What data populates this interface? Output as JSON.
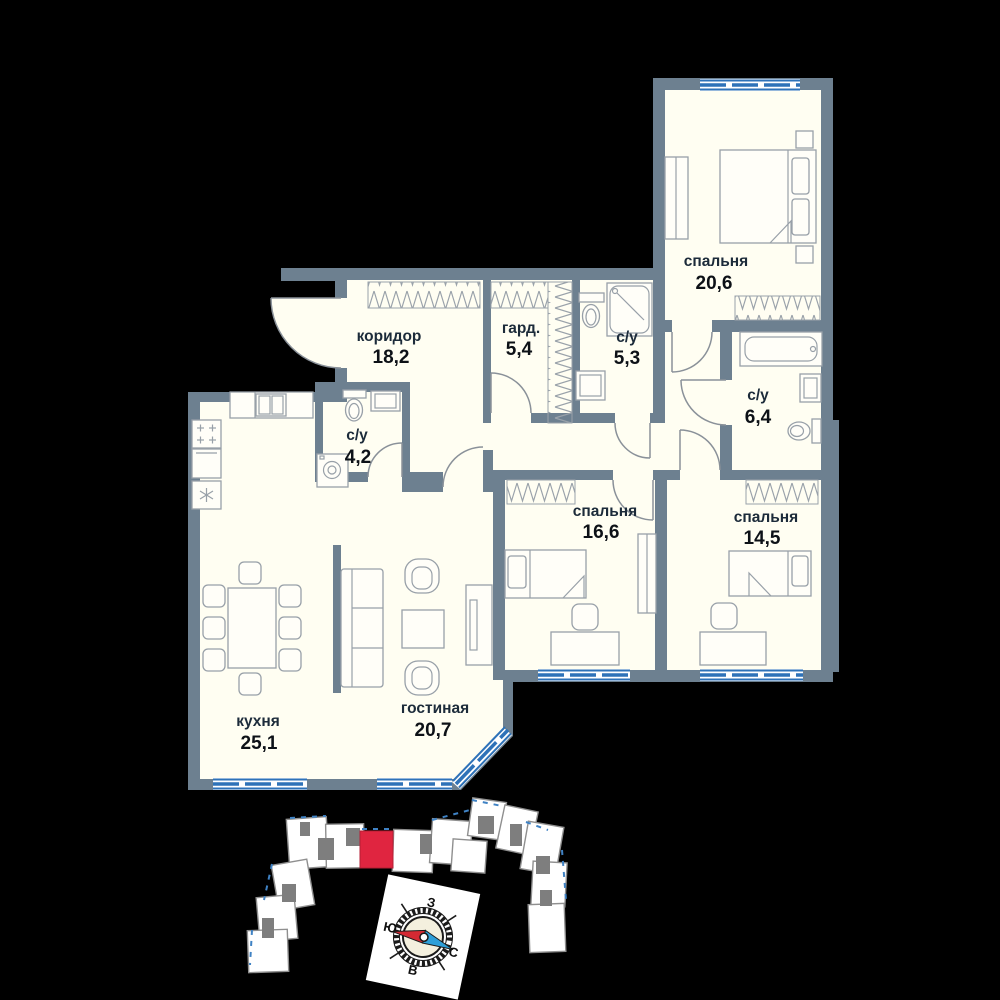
{
  "plan": {
    "rooms": [
      {
        "name": "спальня",
        "area": "20,6"
      },
      {
        "name": "коридор",
        "area": "18,2"
      },
      {
        "name": "гард.",
        "area": "5,4"
      },
      {
        "name": "с/у",
        "area": "5,3"
      },
      {
        "name": "с/у",
        "area": "6,4"
      },
      {
        "name": "с/у",
        "area": "4,2"
      },
      {
        "name": "спальня",
        "area": "16,6"
      },
      {
        "name": "спальня",
        "area": "14,5"
      },
      {
        "name": "кухня",
        "area": "25,1"
      },
      {
        "name": "гостиная",
        "area": "20,7"
      }
    ],
    "compass": {
      "west": "З",
      "south": "Ю",
      "north": "С",
      "east": "В"
    },
    "colors": {
      "background": "#000000",
      "wall": "#6d8090",
      "floor": "#fffef2",
      "window_blue": "#2e72b8",
      "highlight_red": "#e02540",
      "compass_red": "#d42a33",
      "compass_blue": "#2e9fd8"
    }
  }
}
